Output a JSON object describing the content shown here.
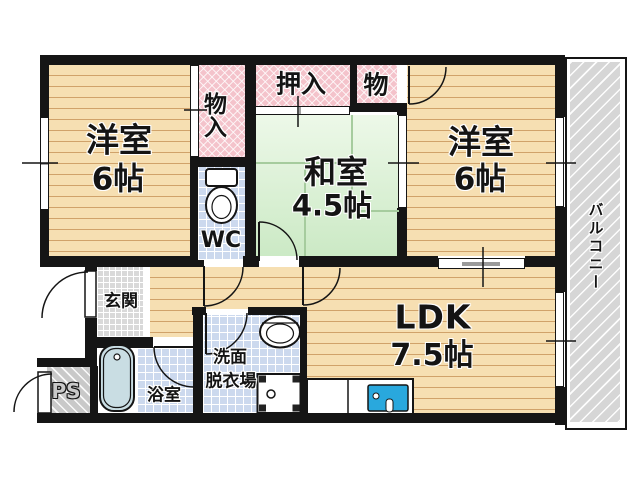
{
  "rooms": {
    "yoshitsu_left": {
      "label": "洋室",
      "size": "6帖"
    },
    "yoshitsu_right": {
      "label": "洋室",
      "size": "6帖"
    },
    "washitsu": {
      "label": "和室",
      "size": "4.5帖"
    },
    "ldk": {
      "label": "LDK",
      "size": "7.5帖"
    },
    "oshiire": {
      "label": "押入"
    },
    "mononyu": {
      "label": "物入"
    },
    "mono": {
      "label": "物"
    },
    "wc": {
      "label": "WC"
    },
    "genkan": {
      "label": "玄関"
    },
    "yokushitsu": {
      "label": "浴室"
    },
    "senmen": {
      "label": "洗面",
      "label2": "脱衣場"
    },
    "ps": {
      "label": "PS"
    },
    "balcony": {
      "label": "バルコニー"
    }
  },
  "fixtures": [
    "toilet",
    "bathtub",
    "washbasin",
    "washing-machine-pan",
    "kitchen-sink"
  ],
  "colors": {
    "wall": "#151515",
    "wood_floor": "#f6dfb2",
    "tatami_green": "#def3d6",
    "closet_pink": "#f4c3cb",
    "tile_blue": "#ccd9ee",
    "entrance_gray": "#d9d9d9",
    "balcony_gray": "#d6d6d6",
    "kitchen_sink_blue": "#29a8dd",
    "bathtub_blue": "#c9dde3"
  }
}
